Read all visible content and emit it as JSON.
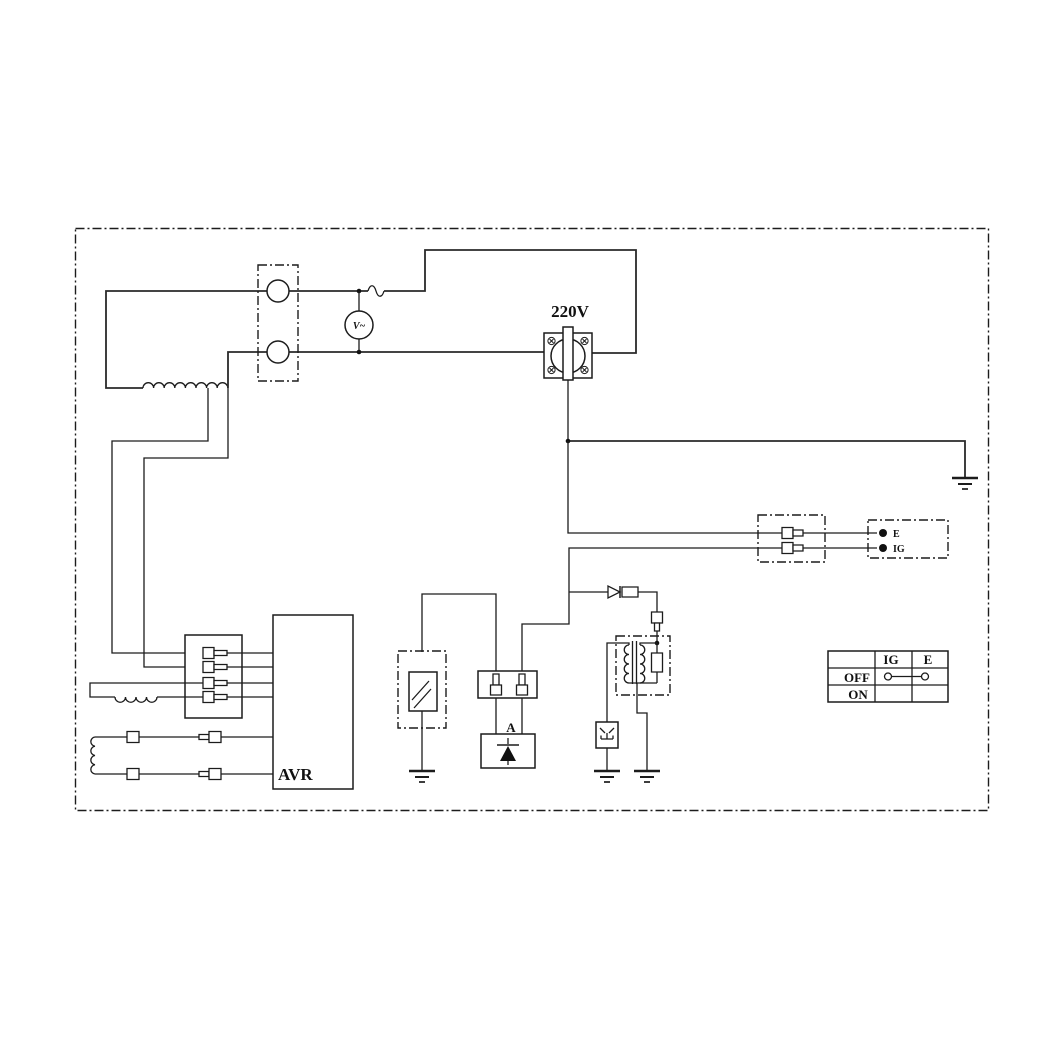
{
  "labels": {
    "outlet_voltage": "220V",
    "voltmeter": "V~",
    "diode_unit": "A",
    "avr": "AVR",
    "terminal_e": "E",
    "terminal_ig": "IG"
  },
  "switch_table": {
    "col_headers": [
      "IG",
      "E"
    ],
    "rows": [
      {
        "label": "OFF",
        "connection": "IG-E bridged"
      },
      {
        "label": "ON",
        "connection": ""
      }
    ]
  },
  "components": [
    "stator-main-winding",
    "voltmeter",
    "fuse",
    "outlet-220v",
    "ground",
    "connector-2pin",
    "terminal-block-e-ig",
    "avr-unit",
    "connector-4pin",
    "exciter-winding",
    "rotor-winding",
    "indicator-lamp",
    "diode-unit-a",
    "ignition-coil",
    "spark-plug",
    "engine-switch-table"
  ],
  "colors": {
    "line": "#1c1c1c",
    "background": "#ffffff"
  }
}
